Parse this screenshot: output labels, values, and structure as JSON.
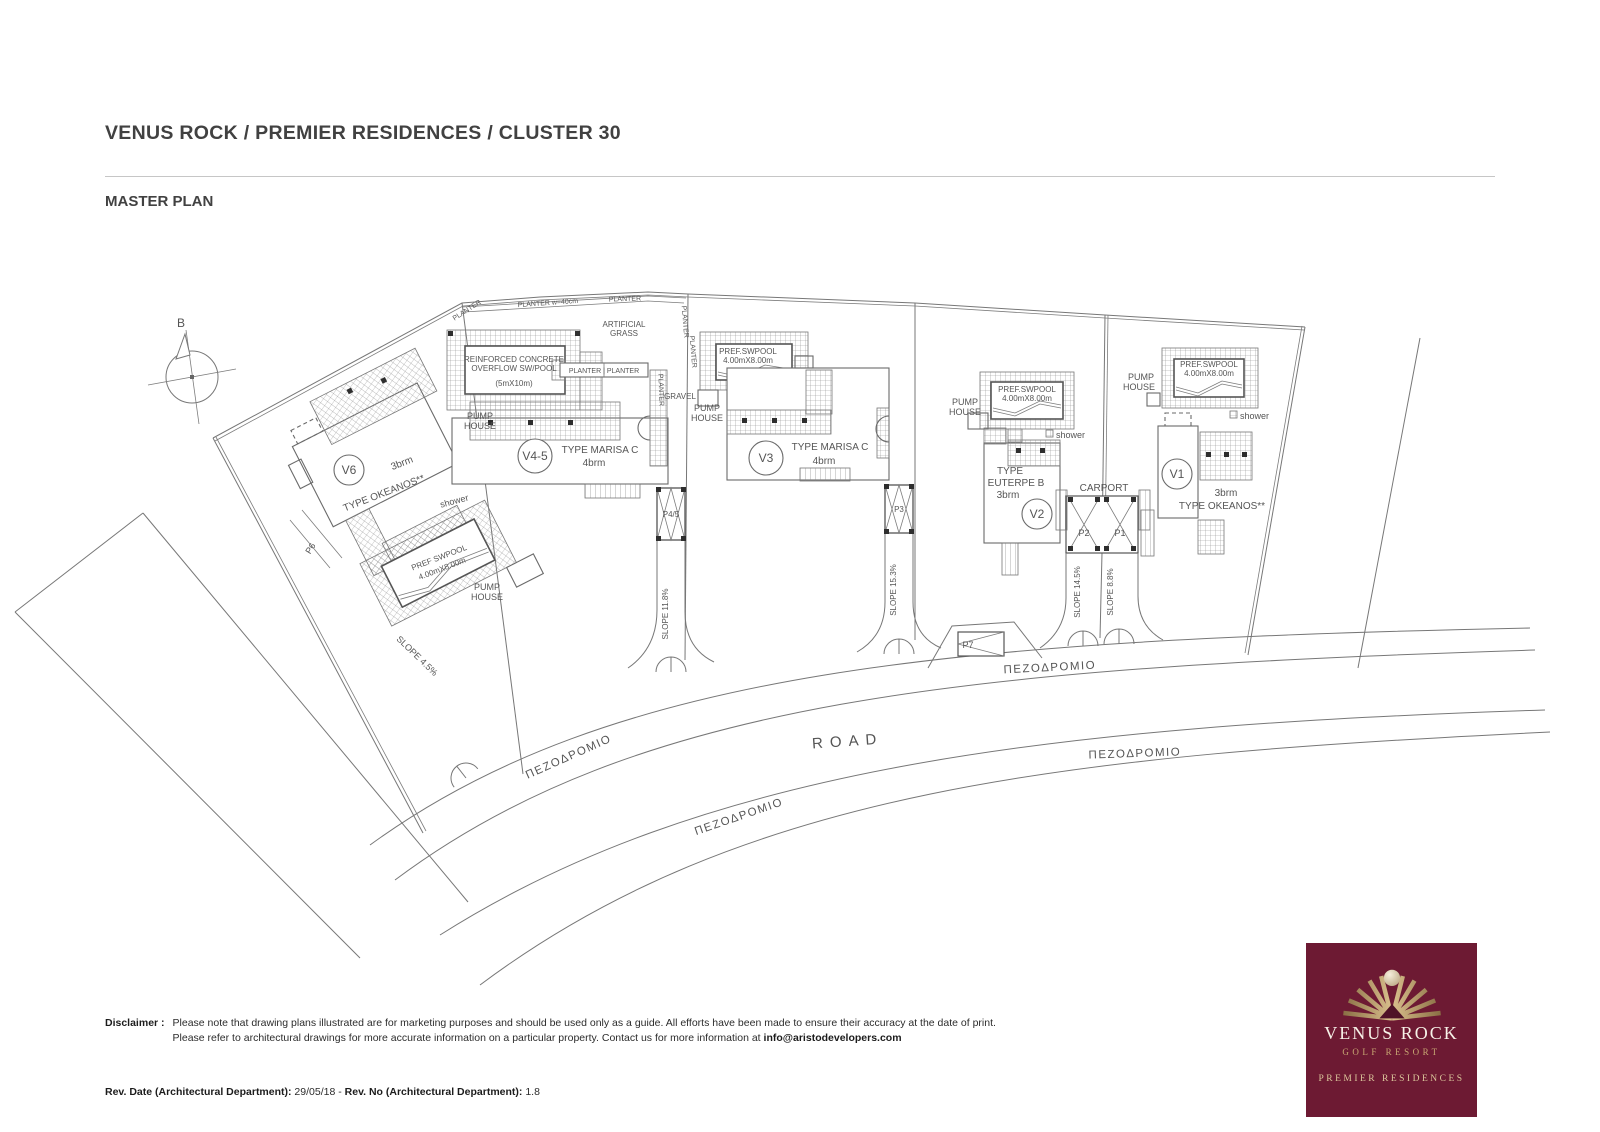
{
  "header": {
    "title": "VENUS ROCK / PREMIER RESIDENCES / CLUSTER 30",
    "subtitle": "MASTER PLAN"
  },
  "plan": {
    "north": "B",
    "road": "ROAD",
    "sidewalk": "ΠΕΖΟΔΡΟΜΙΟ",
    "p7": "P7",
    "pump1": "PUMP",
    "pump2": "HOUSE",
    "shower": "shower",
    "v6": {
      "id": "V6",
      "beds": "3brm",
      "type": "TYPE OKEANOS**",
      "pool1": "PREF SWPOOL",
      "pool2": "4.00mX8.00m",
      "parking": "P6",
      "slope": "SLOPE 4.5%"
    },
    "v45": {
      "id": "V4-5",
      "type": "TYPE MARISA C",
      "beds": "4brm",
      "pool1": "REINFORCED CONCRETE",
      "pool2": "OVERFLOW SW/POOL",
      "pool3": "(5mX10m)",
      "parking": "P4/5",
      "slope": "SLOPE 11.8%",
      "grass1": "ARTIFICIAL",
      "grass2": "GRASS",
      "gravel": "GRAVEL",
      "planter": "PLANTER",
      "planter40": "PLANTER w=40cm",
      "planter_pair": "PLANTER | PLANTER"
    },
    "v3": {
      "id": "V3",
      "type": "TYPE MARISA C",
      "beds": "4brm",
      "pool1": "PREF.SWPOOL",
      "pool2": "4.00mX8.00m",
      "parking": "P3",
      "slope": "SLOPE 15.3%"
    },
    "v2": {
      "id": "V2",
      "type1": "TYPE",
      "type2": "EUTERPE B",
      "beds": "3brm",
      "pool1": "PREF.SWPOOL",
      "pool2": "4.00mX8.00m",
      "carport": "CARPORT",
      "p1": "P1",
      "p2": "P2",
      "slope1": "SLOPE 14.5%",
      "slope2": "SLOPE 8.8%"
    },
    "v1": {
      "id": "V1",
      "beds": "3brm",
      "type": "TYPE OKEANOS**",
      "pool1": "PREF.SWPOOL",
      "pool2": "4.00mX8.00m"
    }
  },
  "footer": {
    "disclaimer_label": "Disclaimer :",
    "disclaimer_line1": "Please note that drawing plans illustrated are for marketing purposes and should be used only as a guide. All efforts have been made to ensure their accuracy at the date of print.",
    "disclaimer_line2": "Please refer to architectural drawings for more accurate information on a particular property. Contact us for more information at ",
    "disclaimer_email": "info@aristodevelopers.com",
    "rev_date_label": "Rev. Date (Architectural Department):",
    "rev_date_value": " 29/05/18 - ",
    "rev_no_label": "Rev. No (Architectural Department):",
    "rev_no_value": " 1.8"
  },
  "logo": {
    "name": "VENUS ROCK",
    "tagline": "GOLF RESORT",
    "sub": "PREMIER RESIDENCES",
    "bg_color": "#6d1a33",
    "gold_color": "#c8a873"
  }
}
